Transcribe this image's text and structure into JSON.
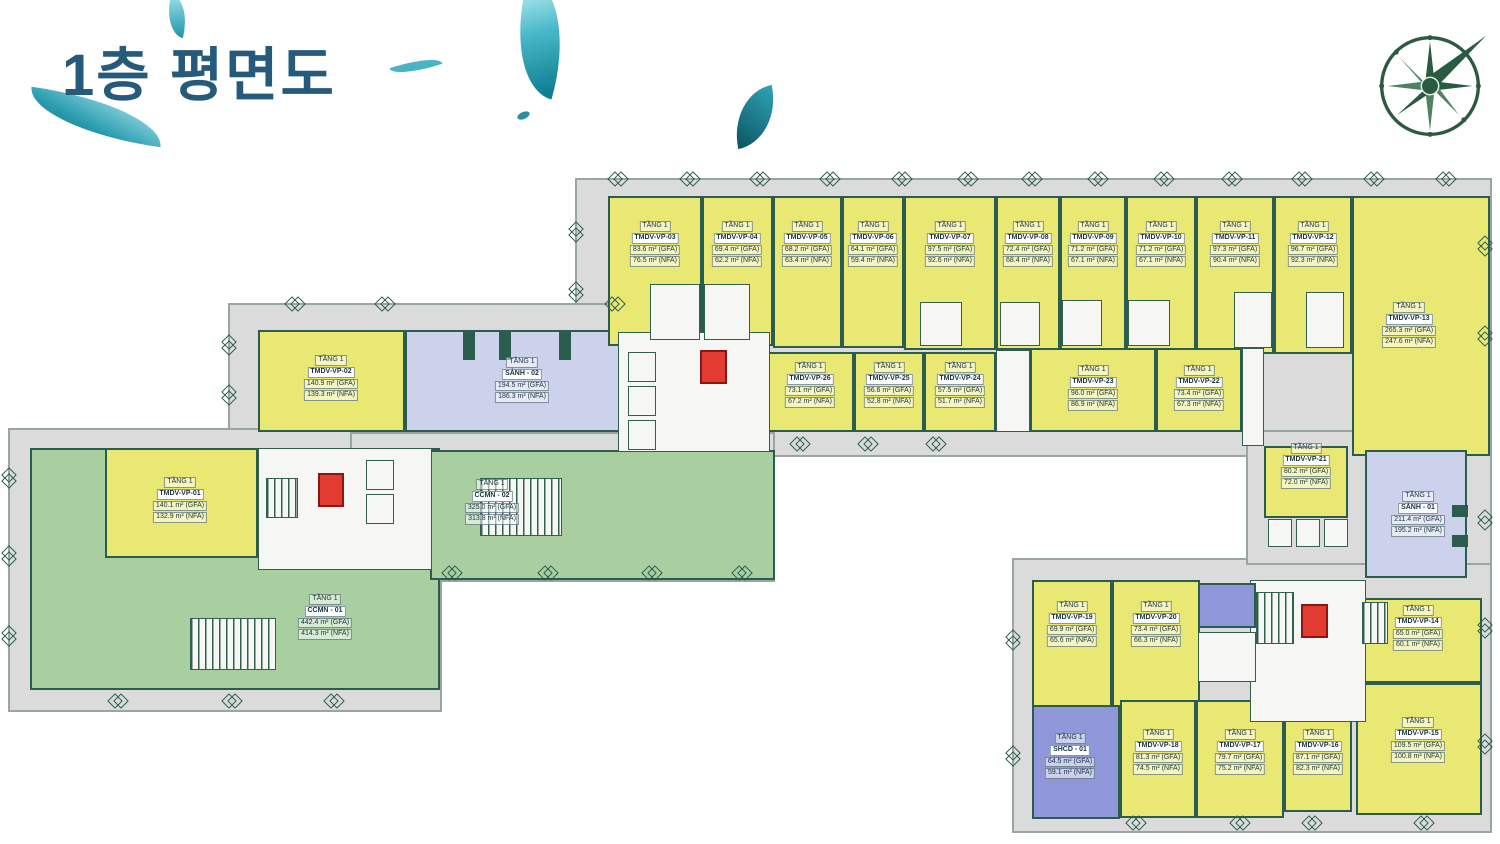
{
  "title": "1층 평면도",
  "floor_label": "TẦNG 1",
  "icons": {
    "compass": "compass-rose-icon",
    "leaves": "leaf-decoration"
  },
  "colors": {
    "office": "#e9e873",
    "lobby": "#cdd2ec",
    "green": "#a9cfa1",
    "community": "#8f97d8",
    "wall": "#2a5d4e",
    "elevator_red": "#e23b32",
    "base_gray": "#dbdbdb",
    "title_blue": "#265a7a",
    "compass_green": "#2a5b41"
  },
  "units": [
    {
      "code": "CCMN - 01",
      "type": "green",
      "gfa": "442.4 m² (GFA)",
      "nfa": "414.3 m² (NFA)",
      "rect": [
        30,
        448,
        410,
        242
      ],
      "label_at": [
        325,
        617
      ]
    },
    {
      "code": "CCMN - 02",
      "type": "green",
      "gfa": "325.0 m² (GFA)",
      "nfa": "313.8 m² (NFA)",
      "rect": [
        430,
        450,
        345,
        130
      ],
      "label_at": [
        492,
        502
      ]
    },
    {
      "code": "TMDV-VP-01",
      "type": "office",
      "gfa": "140.1 m² (GFA)",
      "nfa": "132.9 m² (NFA)",
      "rect": [
        105,
        448,
        153,
        110
      ],
      "label_at": [
        180,
        500
      ]
    },
    {
      "code": "TMDV-VP-02",
      "type": "office",
      "gfa": "140.9 m² (GFA)",
      "nfa": "139.3 m² (NFA)",
      "rect": [
        258,
        330,
        147,
        102
      ],
      "label_at": [
        331,
        378
      ]
    },
    {
      "code": "SẢNH - 02",
      "type": "lobby",
      "gfa": "194.5 m² (GFA)",
      "nfa": "186.3 m² (NFA)",
      "rect": [
        405,
        330,
        237,
        102
      ],
      "label_at": [
        522,
        380
      ]
    },
    {
      "code": "TMDV-VP-03",
      "type": "office",
      "gfa": "83.6 m² (GFA)",
      "nfa": "76.5 m² (NFA)",
      "rect": [
        608,
        196,
        94,
        150
      ],
      "label_at": [
        655,
        244
      ]
    },
    {
      "code": "TMDV-VP-04",
      "type": "office",
      "gfa": "69.4 m² (GFA)",
      "nfa": "62.2 m² (NFA)",
      "rect": [
        702,
        196,
        71,
        150
      ],
      "label_at": [
        737,
        244
      ]
    },
    {
      "code": "TMDV-VP-05",
      "type": "office",
      "gfa": "68.2 m² (GFA)",
      "nfa": "63.4 m² (NFA)",
      "rect": [
        773,
        196,
        69,
        152
      ],
      "label_at": [
        807,
        244
      ]
    },
    {
      "code": "TMDV-VP-06",
      "type": "office",
      "gfa": "64.1 m² (GFA)",
      "nfa": "59.4 m² (NFA)",
      "rect": [
        842,
        196,
        62,
        152
      ],
      "label_at": [
        873,
        244
      ]
    },
    {
      "code": "TMDV-VP-07",
      "type": "office",
      "gfa": "97.5 m² (GFA)",
      "nfa": "92.6 m² (NFA)",
      "rect": [
        904,
        196,
        92,
        154
      ],
      "label_at": [
        950,
        244
      ]
    },
    {
      "code": "TMDV-VP-08",
      "type": "office",
      "gfa": "72.4 m² (GFA)",
      "nfa": "68.4 m² (NFA)",
      "rect": [
        996,
        196,
        64,
        154
      ],
      "label_at": [
        1028,
        244
      ]
    },
    {
      "code": "TMDV-VP-09",
      "type": "office",
      "gfa": "71.2 m² (GFA)",
      "nfa": "67.1 m² (NFA)",
      "rect": [
        1060,
        196,
        66,
        154
      ],
      "label_at": [
        1093,
        244
      ]
    },
    {
      "code": "TMDV-VP-10",
      "type": "office",
      "gfa": "71.2 m² (GFA)",
      "nfa": "67.1 m² (NFA)",
      "rect": [
        1126,
        196,
        70,
        154
      ],
      "label_at": [
        1161,
        244
      ]
    },
    {
      "code": "TMDV-VP-11",
      "type": "office",
      "gfa": "97.3 m² (GFA)",
      "nfa": "90.4 m² (NFA)",
      "rect": [
        1196,
        196,
        78,
        158
      ],
      "label_at": [
        1235,
        244
      ]
    },
    {
      "code": "TMDV-VP-12",
      "type": "office",
      "gfa": "96.7 m² (GFA)",
      "nfa": "92.3 m² (NFA)",
      "rect": [
        1274,
        196,
        78,
        158
      ],
      "label_at": [
        1313,
        244
      ]
    },
    {
      "code": "TMDV-VP-13",
      "type": "office",
      "gfa": "265.3 m² (GFA)",
      "nfa": "247.6 m² (NFA)",
      "rect": [
        1352,
        196,
        138,
        260
      ],
      "label_at": [
        1409,
        325
      ]
    },
    {
      "code": "TMDV-VP-26",
      "type": "office",
      "gfa": "73.1 m² (GFA)",
      "nfa": "67.2 m² (NFA)",
      "rect": [
        766,
        352,
        88,
        80
      ],
      "label_at": [
        810,
        385
      ]
    },
    {
      "code": "TMDV-VP-25",
      "type": "office",
      "gfa": "56.6 m² (GFA)",
      "nfa": "52.8 m² (NFA)",
      "rect": [
        854,
        352,
        70,
        80
      ],
      "label_at": [
        889,
        385
      ]
    },
    {
      "code": "TMDV-VP-24",
      "type": "office",
      "gfa": "57.5 m² (GFA)",
      "nfa": "51.7 m² (NFA)",
      "rect": [
        924,
        352,
        72,
        80
      ],
      "label_at": [
        960,
        385
      ]
    },
    {
      "code": "TMDV-VP-23",
      "type": "office",
      "gfa": "96.0 m² (GFA)",
      "nfa": "86.9 m² (NFA)",
      "rect": [
        1030,
        348,
        126,
        84
      ],
      "label_at": [
        1093,
        388
      ]
    },
    {
      "code": "TMDV-VP-22",
      "type": "office",
      "gfa": "73.4 m² (GFA)",
      "nfa": "67.3 m² (NFA)",
      "rect": [
        1156,
        348,
        86,
        84
      ],
      "label_at": [
        1199,
        388
      ]
    },
    {
      "code": "TMDV-VP-21",
      "type": "office",
      "gfa": "80.2 m² (GFA)",
      "nfa": "72.0 m² (NFA)",
      "rect": [
        1264,
        446,
        84,
        72
      ],
      "label_at": [
        1306,
        466
      ]
    },
    {
      "code": "SẢNH - 01",
      "type": "lobby",
      "gfa": "211.4 m² (GFA)",
      "nfa": "195.2 m² (NFA)",
      "rect": [
        1365,
        450,
        102,
        128
      ],
      "label_at": [
        1418,
        514
      ]
    },
    {
      "code": "TMDV-VP-19",
      "type": "office",
      "gfa": "69.9 m² (GFA)",
      "nfa": "65.6 m² (NFA)",
      "rect": [
        1032,
        580,
        80,
        136
      ],
      "label_at": [
        1072,
        624
      ]
    },
    {
      "code": "TMDV-VP-20",
      "type": "office",
      "gfa": "73.4 m² (GFA)",
      "nfa": "66.3 m² (NFA)",
      "rect": [
        1112,
        580,
        88,
        136
      ],
      "label_at": [
        1156,
        624
      ]
    },
    {
      "code": "SHCD - 01",
      "type": "community",
      "gfa": "64.5 m² (GFA)",
      "nfa": "59.1 m² (NFA)",
      "rect": [
        1032,
        705,
        88,
        114
      ],
      "label_at": [
        1070,
        756
      ]
    },
    {
      "code": "TMDV-VP-18",
      "type": "office",
      "gfa": "81.3 m² (GFA)",
      "nfa": "74.5 m² (NFA)",
      "rect": [
        1120,
        700,
        76,
        118
      ],
      "label_at": [
        1158,
        752
      ]
    },
    {
      "code": "TMDV-VP-17",
      "type": "office",
      "gfa": "79.7 m² (GFA)",
      "nfa": "75.2 m² (NFA)",
      "rect": [
        1196,
        700,
        88,
        118
      ],
      "label_at": [
        1240,
        752
      ]
    },
    {
      "code": "TMDV-VP-16",
      "type": "office",
      "gfa": "87.1 m² (GFA)",
      "nfa": "82.3 m² (NFA)",
      "rect": [
        1284,
        700,
        68,
        112
      ],
      "label_at": [
        1318,
        752
      ]
    },
    {
      "code": "TMDV-VP-15",
      "type": "office",
      "gfa": "109.5 m² (GFA)",
      "nfa": "100.8 m² (NFA)",
      "rect": [
        1356,
        683,
        126,
        132
      ],
      "label_at": [
        1418,
        740
      ]
    },
    {
      "code": "TMDV-VP-14",
      "type": "office",
      "gfa": "65.0 m² (GFA)",
      "nfa": "60.1 m² (NFA)",
      "rect": [
        1356,
        598,
        126,
        85
      ],
      "label_at": [
        1418,
        628
      ]
    }
  ]
}
